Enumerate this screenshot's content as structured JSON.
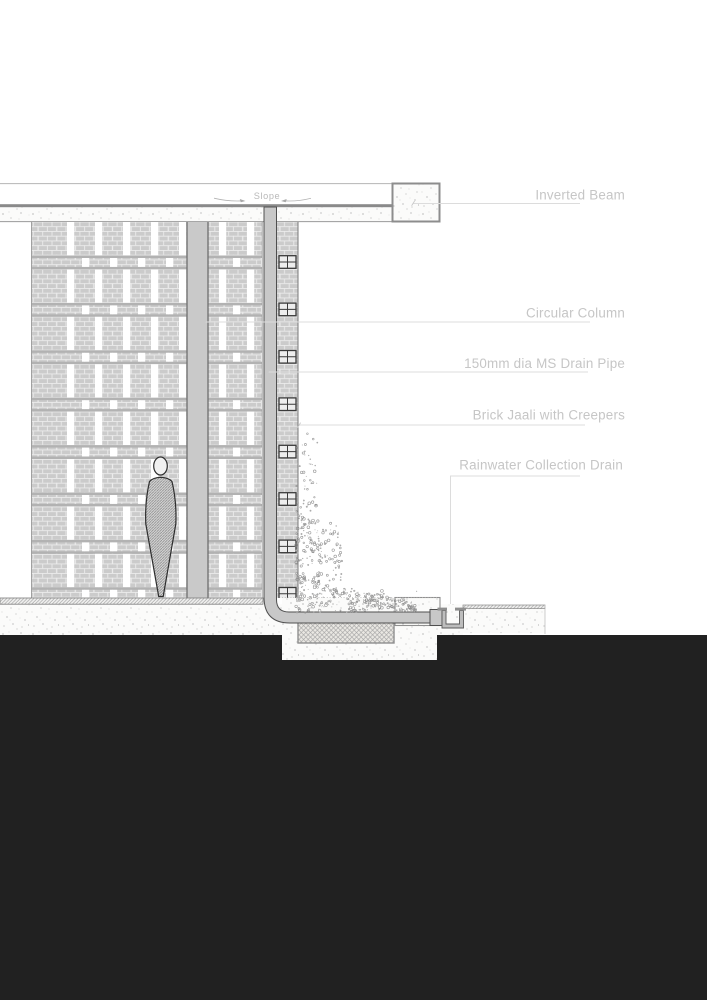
{
  "drawing": {
    "slope_label": "Slope",
    "callouts": [
      {
        "id": "inverted-beam",
        "label": "Inverted Beam"
      },
      {
        "id": "circular-column",
        "label": "Circular Column"
      },
      {
        "id": "drain-pipe",
        "label": "150mm dia MS Drain Pipe"
      },
      {
        "id": "brick-jaali",
        "label": "Brick Jaali with Creepers"
      },
      {
        "id": "rainwater-drain",
        "label": "Rainwater Collection Drain"
      }
    ],
    "palette": {
      "label_text": "#c6c6c6",
      "leader_line": "#dcdcdc",
      "ground_black": "#212121",
      "brick": "#cbcbcb",
      "band_stripe": "#b2b2b2",
      "concrete_edge": "#8a8a8a",
      "pipe_fill": "#c8c8c8"
    }
  }
}
